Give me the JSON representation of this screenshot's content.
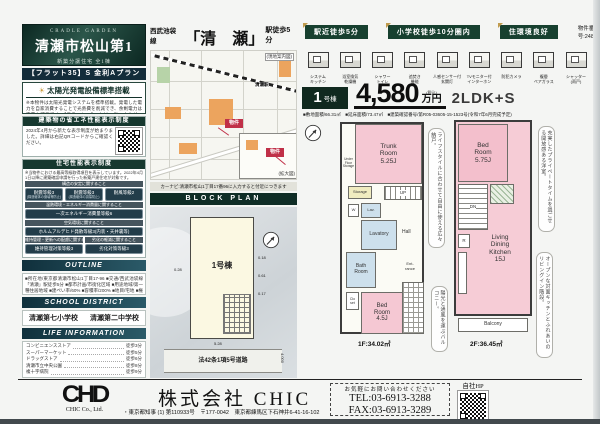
{
  "colors": {
    "header_green": "#0c2822",
    "banner_navy": "#132c3a",
    "badge_green": "#17402f",
    "room_pink": "#f5c8d3",
    "room_blue": "#cde0ec",
    "map_orange": "#eca45e",
    "marker_red": "#c03048",
    "gold": "#c09b4e"
  },
  "left": {
    "brand": "CRADLE GARDEN",
    "title": "清瀬市松山第1",
    "subtitle": "新築分譲住宅 全1棟",
    "flat35": "【フラット35】S 金利Aプラン",
    "solar": {
      "header": "太陽光発電設備標準搭載",
      "body": "※本物件は太陽光発電システムを標準搭載。発電した電力を自家消費することで光熱費を削減でき、余剰電力は売電も可能です。【フラット35】Sとは、省エネルギー性・耐震性などに優れた住宅を取得される場合に、借入金利を一定期間引き下げる制度です。適用には住宅金融支援機構の定める技術基準に適合し、物件検査に合格することが必要です。金利・ご返済条件等の詳細は係員までお問い合わせください。"
    },
    "energy": {
      "header": "建築物の省エネ性能表示制度",
      "body": "2024年4月から新たな表示制度が始まりました。詳細は右記QRコードからご確認ください。"
    },
    "performance": {
      "header": "住宅性能表示制度",
      "intro": "※当物件における最高等級取得項目を表示しています。2022年4月1日以降に建築確認申請を行った新築戸建住宅が対象です。",
      "row1_header": "構造の安定に関すること",
      "badge1": "耐震等級3",
      "badge1_sub": "(構造躯体の倒壊等防止)",
      "badge2": "耐震等級3",
      "badge2_sub": "(構造躯体の損傷防止)",
      "badge3": "耐風等級2",
      "row2_header": "温熱環境・エネルギー消費量に関すること",
      "badge4": "一次エネルギー消費量等級6",
      "row3_header": "空気環境に関すること",
      "badge5": "ホルムアルデヒド発散等級3(内装・天井裏等)",
      "row4a_header": "維持管理・更新への配慮に関すること",
      "row4b_header": "劣化の軽減に関すること",
      "badge6": "維持管理対策等級3",
      "badge7": "劣化対策等級3"
    },
    "outline": {
      "header": "OUTLINE",
      "body": "■所在地/東京都清瀬市松山1丁目17-96 ■交通/西武池袋線「清瀬」駅徒歩5分 ■都市計画/市街化区域 ■用途地域/第一種住居地域 ■建ぺい率/60% ■容積率/200% ■地目/宅地 ■権利/所有権 ■構造/木造在来工法2階建 ■駐車場/有(1台) ■私道負担/無 ■設備/公営水道・公共下水・都市ガス ■建築確認番号/第R05-03605-15-1523号 ■完成予定/令和7年6月 ■引渡し/相談 ■取引態様/売主"
    },
    "school": {
      "header": "SCHOOL DISTRICT",
      "elementary": "清瀬第七小学校",
      "junior_high": "清瀬第二中学校"
    },
    "life": {
      "header": "LIFE INFORMATION",
      "items": [
        {
          "name": "コンビニエンスストア",
          "dist": "徒歩3分"
        },
        {
          "name": "スーパーマーケット",
          "dist": "徒歩5分"
        },
        {
          "name": "ドラッグストア",
          "dist": "徒歩6分"
        },
        {
          "name": "清瀬市立中央公園",
          "dist": "徒歩8分"
        },
        {
          "name": "複十字病院",
          "dist": "徒歩9分"
        }
      ]
    }
  },
  "middle": {
    "route": {
      "line": "西武池袋線",
      "station": "「清　瀬」",
      "walk": "駅徒歩5分"
    },
    "map": {
      "corner_note": "(現地案内図)",
      "inset_note": "(拡大図)",
      "station_label": "清瀬駅",
      "marker_label": "物件",
      "marker2_label": "物件"
    },
    "caption": "カーナビ:清瀬市松山1丁目17番96に入力すると付近につきます",
    "block_plan": {
      "header": "BLOCK PLAN",
      "lot_label": "1号棟",
      "dim_left": "0.28",
      "dim_r1": "0.18",
      "dim_r2": "0.61",
      "dim_r3": "0.17",
      "dim_bottom": "5.28",
      "dim_road": "4.000",
      "road_label": "法42条1項5号道路"
    }
  },
  "right": {
    "badges": [
      "駅近徒歩5分",
      "小学校徒歩10分圏内",
      "住環境良好"
    ],
    "property_number": "物件番号:24882",
    "features": [
      {
        "label": "システム\nキッチン"
      },
      {
        "label": "浴室換気\n乾燥機"
      },
      {
        "label": "シャワー\nトイレ"
      },
      {
        "label": "追焚き\n機能"
      },
      {
        "label": "人感センサー付\n玄関灯"
      },
      {
        "label": "TVモニター付\nインターホン"
      },
      {
        "label": "防犯カメラ"
      },
      {
        "label": "複層\nペアガラス"
      },
      {
        "label": "シャッター\n(雨戸)"
      }
    ],
    "price_row": {
      "unit_num": "1",
      "unit_suffix": "号棟",
      "price": "4,580",
      "tax_note": "(税込)",
      "price_unit": "万円",
      "layout": "2LDK+S"
    },
    "specs": "■敷地面積/66.31㎡　■延床面積/73.47㎡　■建築確認番号/第R05-03605-15-1523号(令和7年6月完成予定)",
    "plan1f": {
      "rooms": {
        "trunk": "Trunk\nRoom\n5.25J",
        "ufs": "Under\nFloor\nStorage",
        "storage": "Storage",
        "up": "UP",
        "w": "W",
        "lav": "Lav.",
        "lavatory": "Lavatory",
        "hall": "Hall",
        "bath": "Bath\nRoom",
        "clo": "Clo\nset",
        "bed": "Bed\nRoom\n4.5J",
        "entrance": "Ent-\nrance"
      },
      "area": "1F:34.02㎡",
      "note_storage": "ライフスタイルに合わせて自由に使える広々納戸。",
      "note_balcony": "陽光と通風を運ぶバルコニー。"
    },
    "plan2f": {
      "rooms": {
        "bed": "Bed\nRoom\n5.75J",
        "dn": "DN",
        "r": "R",
        "ldk": "Living\nDining\nKitchen\n15J",
        "balcony": "Balcony"
      },
      "area": "2F:36.45㎡",
      "note_bedroom": "充実したプライベートタイムを過ごせる開放感ある洋室。",
      "note_ldk": "オープンな対面キッチンとふれあいのリビングイン階段。"
    }
  },
  "footer": {
    "logo": "CHD",
    "logo_sub": "CHIC Co., Ltd.",
    "company": "株式会社 CHIC",
    "license": "・東京都知事 (1) 第110933号　〒177-0042　東京都練馬区下石神井6-41-16-102",
    "contact_note": "お気軽にお問い合わせください",
    "tel": "TEL:03-6913-3288",
    "fax": "FAX:03-6913-3289",
    "hp_label": "自社HP"
  }
}
